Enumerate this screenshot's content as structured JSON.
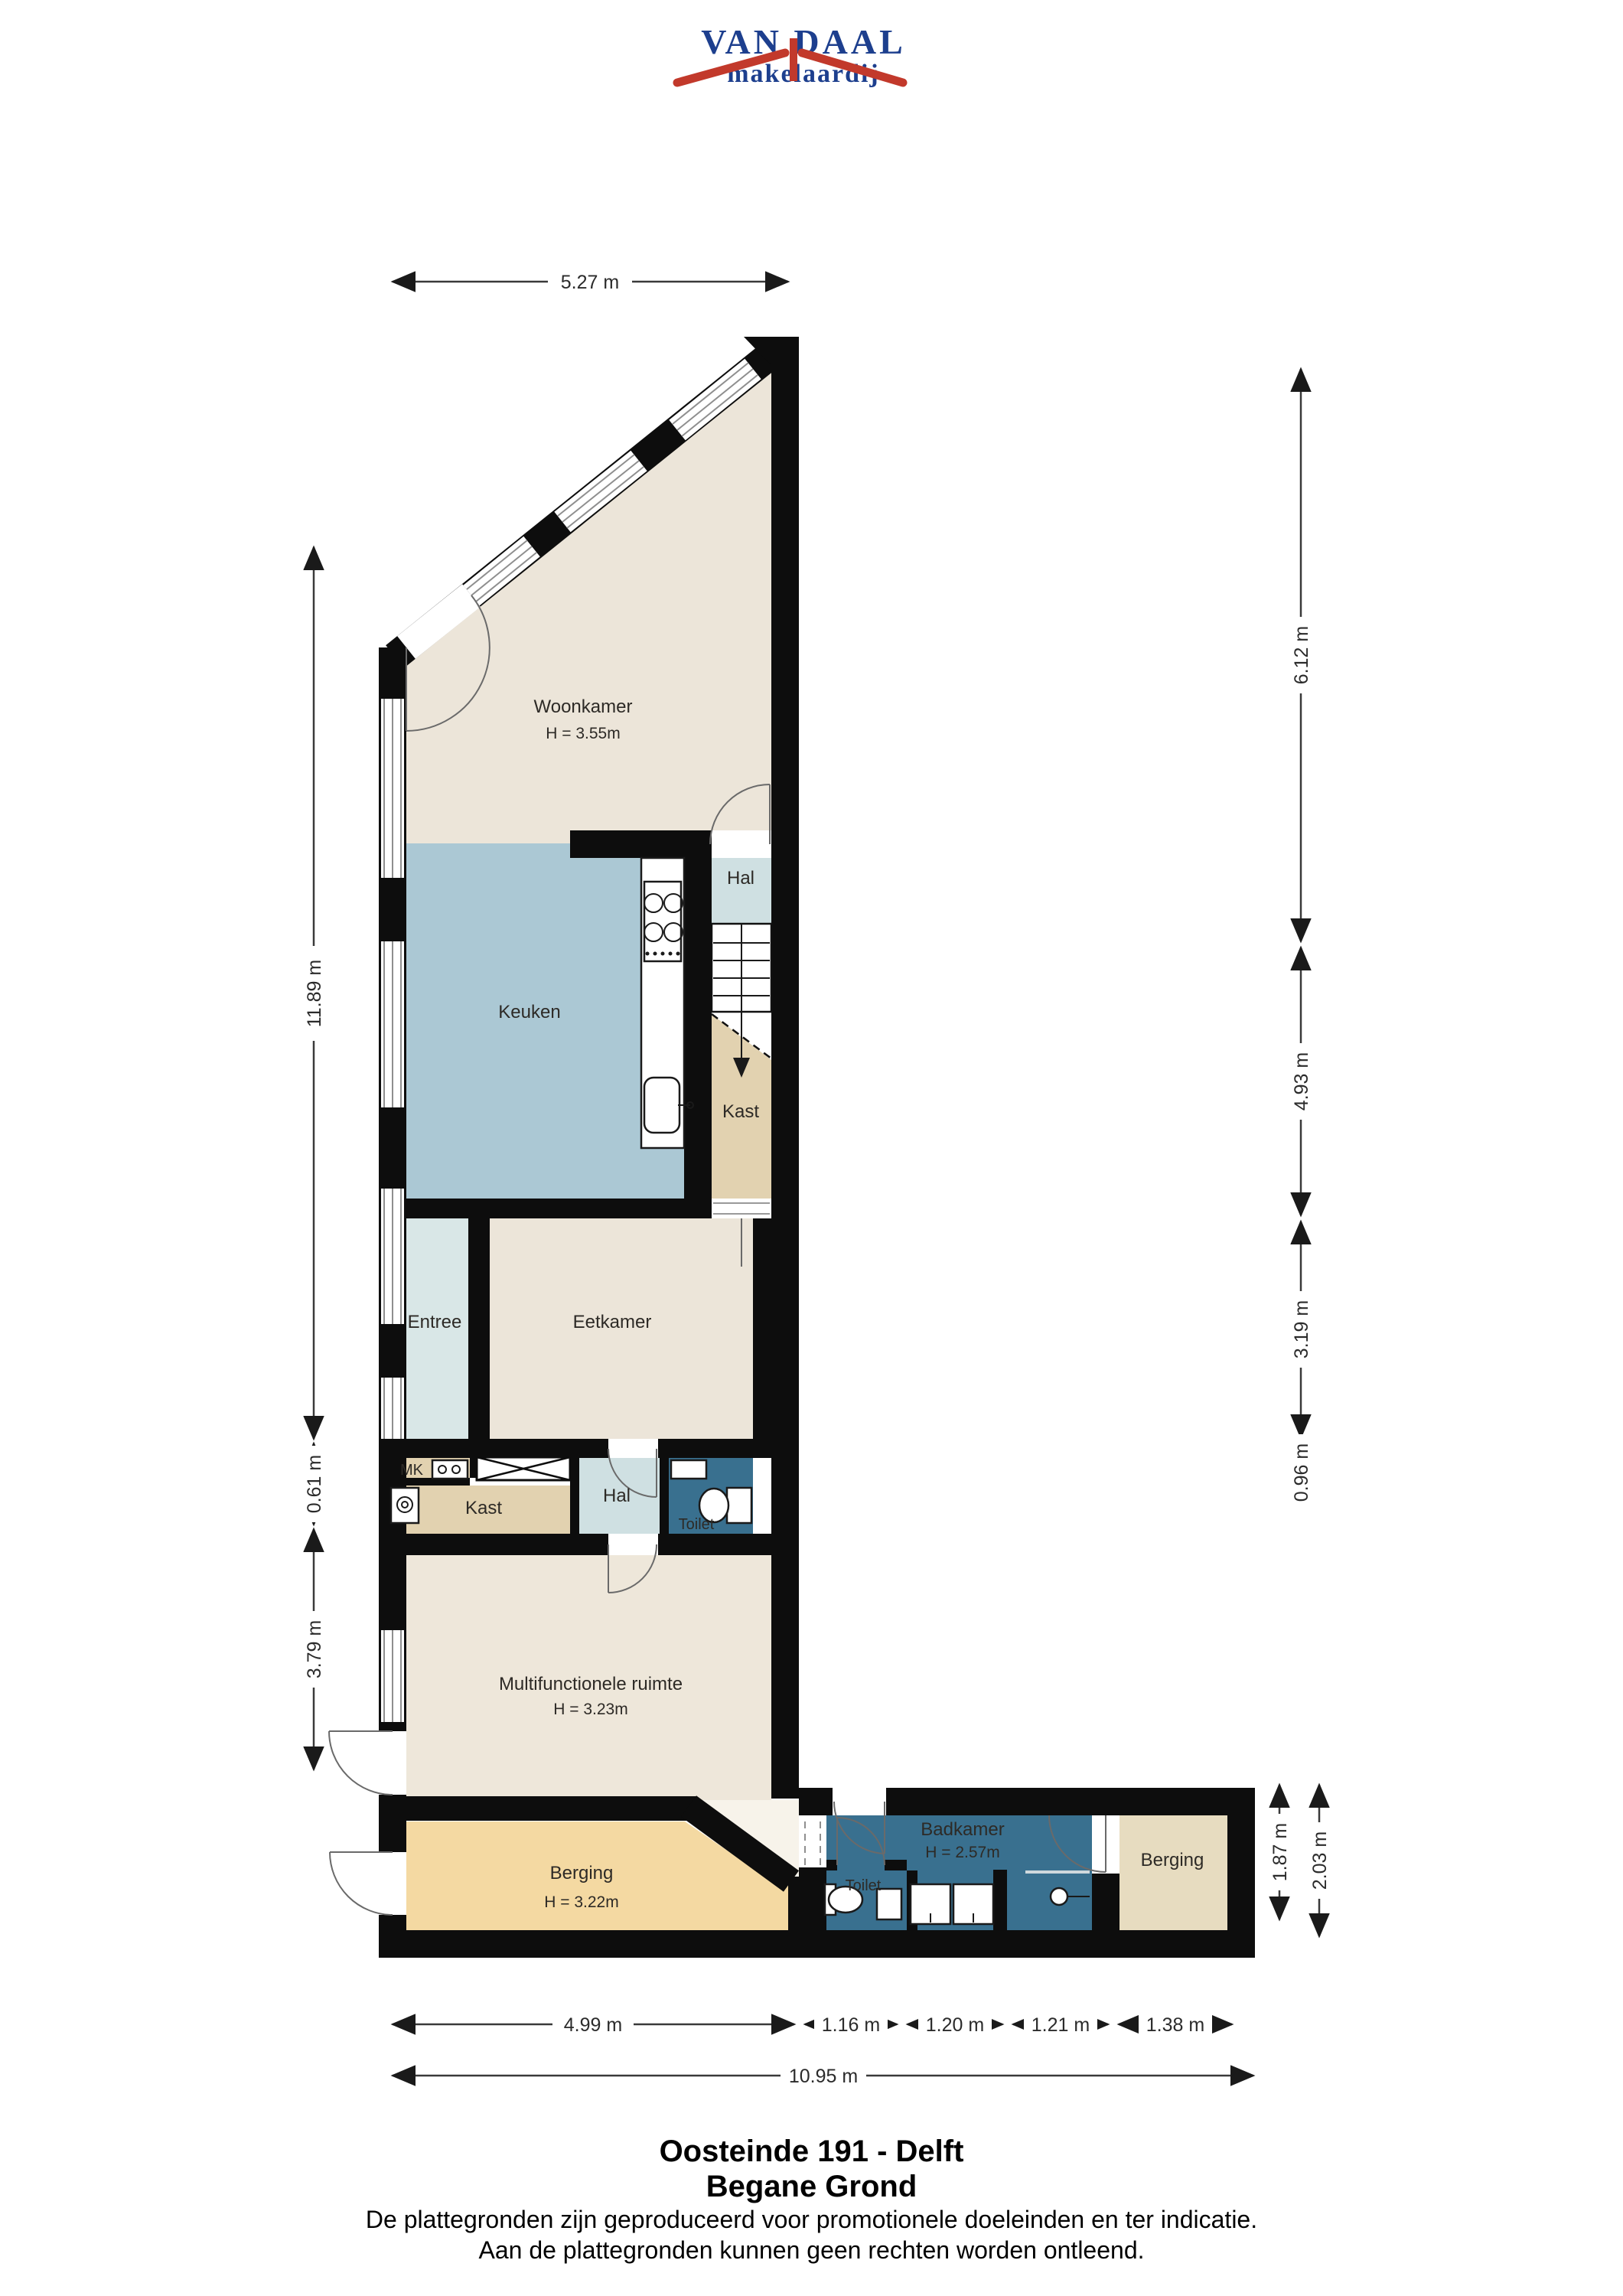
{
  "logo": {
    "name": "VAN DAAL",
    "tagline": "makelaardij"
  },
  "rooms": {
    "woonkamer": {
      "label": "Woonkamer",
      "height": "H = 3.55m"
    },
    "keuken": {
      "label": "Keuken"
    },
    "hal_boven": {
      "label": "Hal"
    },
    "kast_boven": {
      "label": "Kast"
    },
    "entree": {
      "label": "Entree"
    },
    "eetkamer": {
      "label": "Eetkamer"
    },
    "mk": {
      "label": "MK"
    },
    "kast_midden": {
      "label": "Kast"
    },
    "hal_midden": {
      "label": "Hal"
    },
    "toilet_midden": {
      "label": "Toilet"
    },
    "multifunctionele_ruimte": {
      "label": "Multifunctionele ruimte",
      "height": "H = 3.23m"
    },
    "berging_links": {
      "label": "Berging",
      "height": "H = 3.22m"
    },
    "toilet_onder": {
      "label": "Toilet"
    },
    "badkamer": {
      "label": "Badkamer",
      "height": "H = 2.57m"
    },
    "berging_rechts": {
      "label": "Berging"
    }
  },
  "dimensions": {
    "top": "5.27 m",
    "left": [
      "11.89 m",
      "0.61 m",
      "3.79 m"
    ],
    "right": [
      "6.12 m",
      "4.93 m",
      "3.19 m",
      "0.96 m"
    ],
    "bottom_right": [
      "1.87 m",
      "2.03 m"
    ],
    "bottom": [
      "4.99 m",
      "1.16 m",
      "1.20 m",
      "1.21 m",
      "1.38 m"
    ],
    "bottom_total": "10.95 m"
  },
  "footer": {
    "address": "Oosteinde 191 - Delft",
    "floor": "Begane Grond",
    "disclaimer_line1": "De plattegronden zijn geproduceerd voor promotionele doeleinden en ter indicatie.",
    "disclaimer_line2": "Aan de plattegronden kunnen geen rechten worden ontleend."
  },
  "colors": {
    "wall": "#0d0d0d",
    "living_cream": "#ece5d9",
    "kitchen_blue": "#abc8d4",
    "hall_light": "#cfe0e2",
    "entree_light": "#d9e7e7",
    "closet_tan": "#e2d2b0",
    "storage_orange": "#f4d9a2",
    "storage_tan": "#e7dcc0",
    "bath_blue": "#39708f",
    "logo_red": "#c2392b",
    "logo_blue": "#1d3f8e"
  }
}
